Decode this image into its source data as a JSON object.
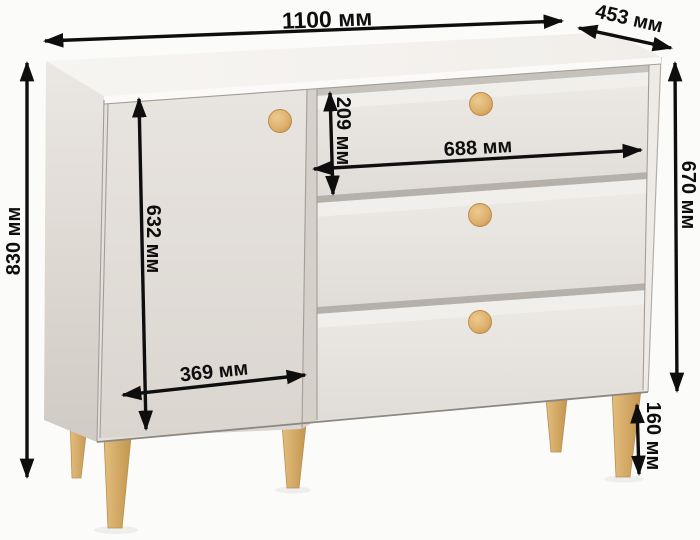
{
  "diagram_type": "furniture-dimension-diagram",
  "object": "chest-of-drawers-with-door-and-3-drawers",
  "unit": "мм",
  "colors": {
    "background": "#fbfbfa",
    "annotation": "#0e0e0e",
    "top_surface": "#f6f4f1",
    "side_panel": "#ddd8d2",
    "front_face": "#e4e0db",
    "door": "#e1dcd6",
    "drawer_front": "#e7e4df",
    "knob_wood": "#ddb172",
    "leg_wood": "#d9b06c"
  },
  "dimensions": {
    "overall_width": {
      "value_mm": 1100,
      "label": "1100 мм"
    },
    "depth": {
      "value_mm": 453,
      "label": "453 мм"
    },
    "overall_height": {
      "value_mm": 830,
      "label": "830 мм"
    },
    "door_height": {
      "value_mm": 632,
      "label": "632 мм"
    },
    "drawer_front_height": {
      "value_mm": 209,
      "label": "209 мм"
    },
    "drawer_width": {
      "value_mm": 688,
      "label": "688 мм"
    },
    "door_width": {
      "value_mm": 369,
      "label": "369 мм"
    },
    "body_height": {
      "value_mm": 670,
      "label": "670 мм"
    },
    "leg_height": {
      "value_mm": 160,
      "label": "160 мм"
    }
  }
}
